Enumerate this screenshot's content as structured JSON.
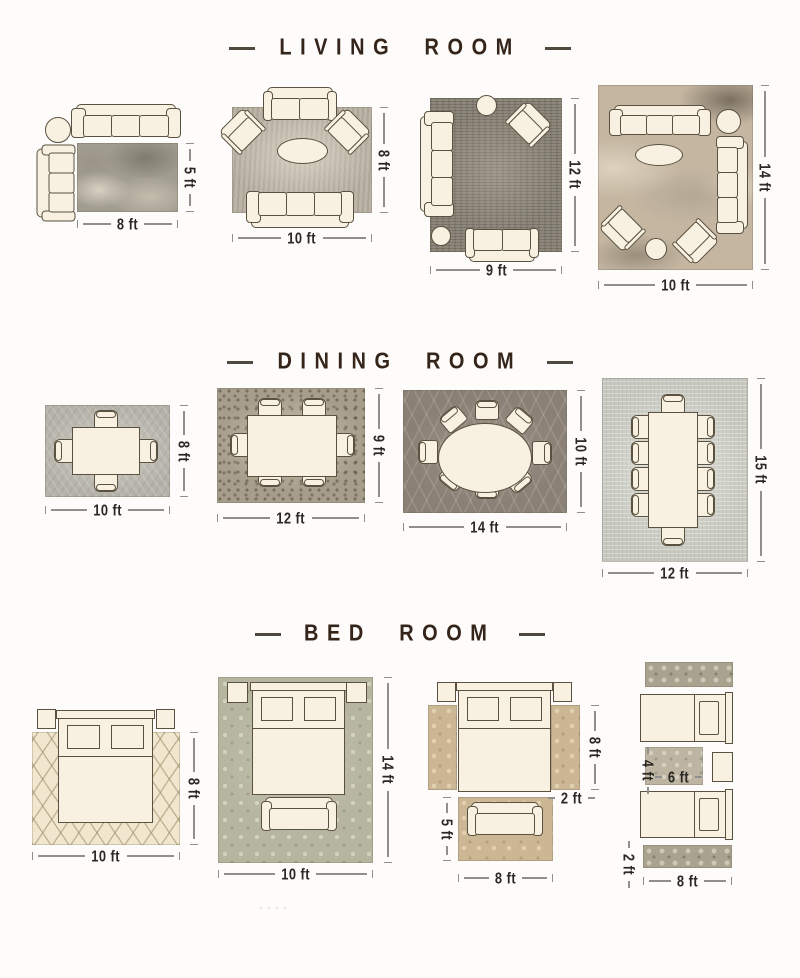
{
  "colors": {
    "background": "#fdfcfa",
    "furniture_fill": "#f8f1e1",
    "furniture_outline": "#5a5140",
    "header_text": "#35241a",
    "dimension_text": "#2b2823",
    "dimension_line": "#8f8f8f"
  },
  "sections": [
    {
      "title": "LIVING ROOM",
      "layouts": [
        {
          "width": "8 ft",
          "height": "5 ft"
        },
        {
          "width": "10 ft",
          "height": "8 ft"
        },
        {
          "width": "9 ft",
          "height": "12 ft"
        },
        {
          "width": "10 ft",
          "height": "14 ft"
        }
      ]
    },
    {
      "title": "DINING ROOM",
      "layouts": [
        {
          "width": "10 ft",
          "height": "8 ft"
        },
        {
          "width": "12 ft",
          "height": "9 ft"
        },
        {
          "width": "14 ft",
          "height": "10 ft"
        },
        {
          "width": "12 ft",
          "height": "15 ft"
        }
      ]
    },
    {
      "title": "BED ROOM",
      "layouts": [
        {
          "width": "10 ft",
          "height": "8 ft"
        },
        {
          "width": "10 ft",
          "height": "14 ft"
        },
        {
          "width": "8 ft",
          "height": "8 ft",
          "runner_width": "2 ft",
          "foot_rug_height": "5 ft"
        },
        {
          "width": "8 ft",
          "runner_height": "2 ft",
          "middle_rug_width": "6 ft",
          "middle_rug_height": "4 ft"
        }
      ]
    }
  ]
}
